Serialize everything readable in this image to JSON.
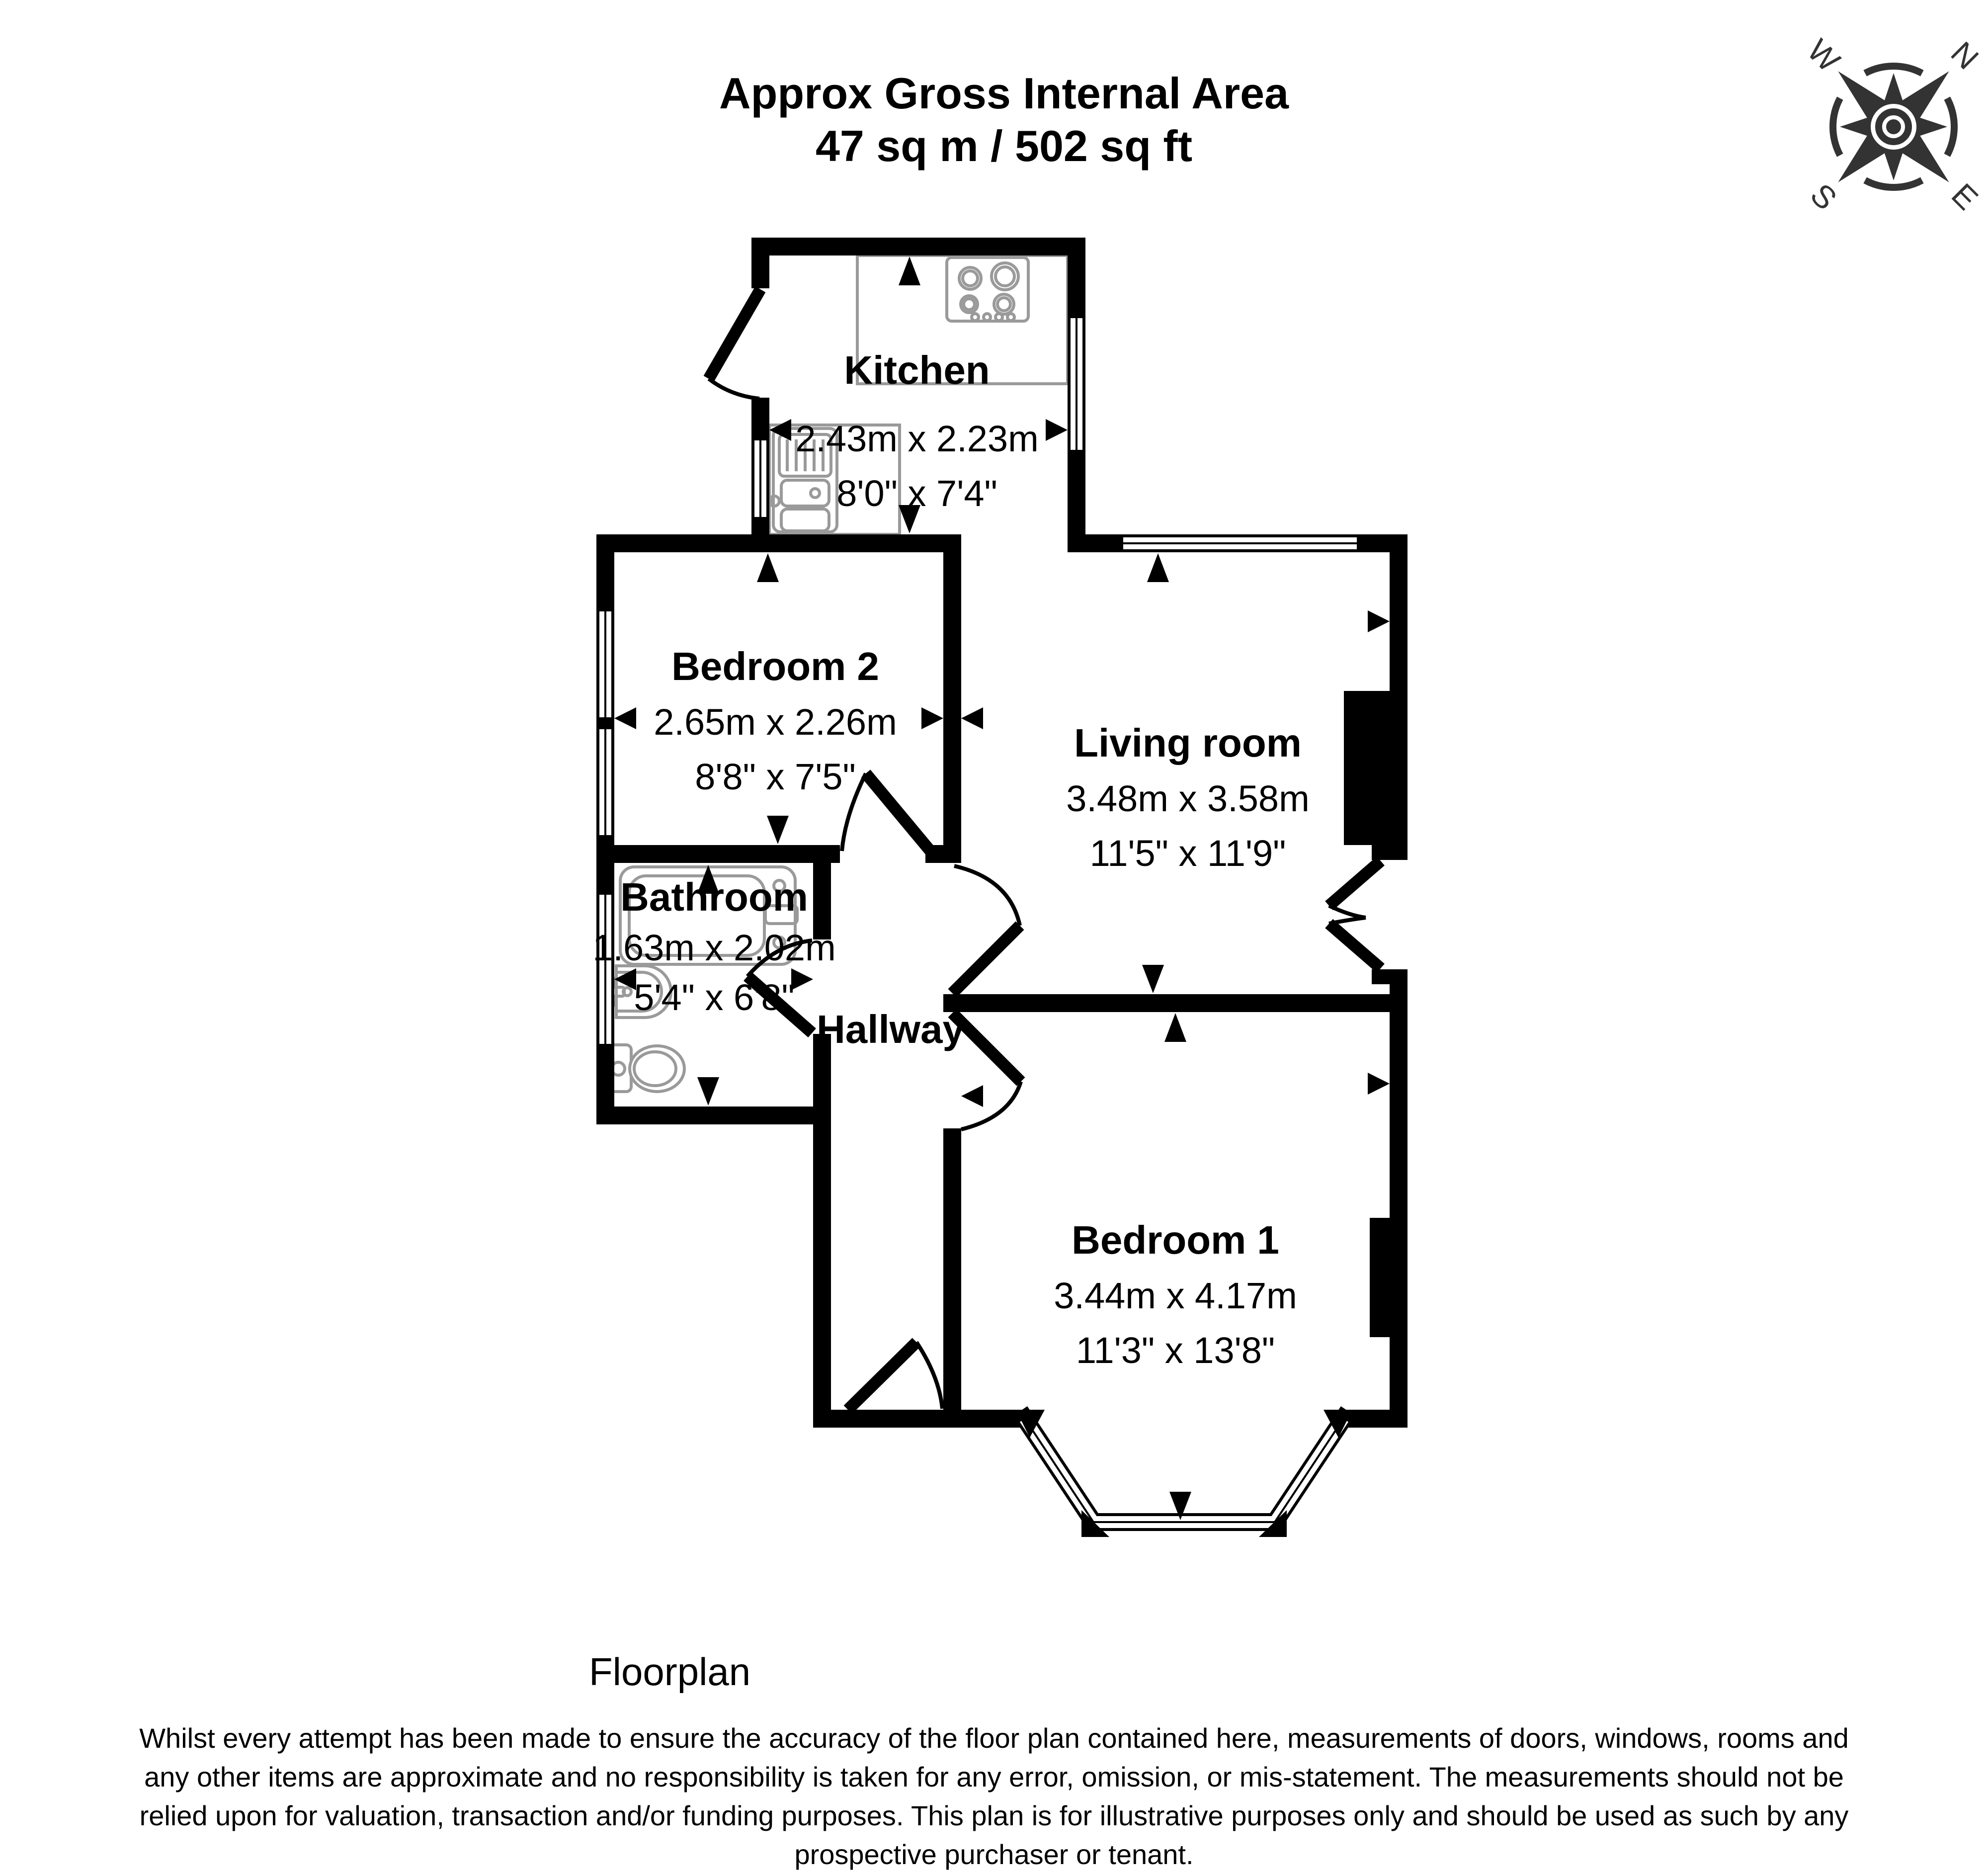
{
  "title": {
    "line1": "Approx Gross Internal Area",
    "line2": "47 sq m / 502 sq ft"
  },
  "compass": {
    "north": "N",
    "east": "E",
    "south": "S",
    "west": "W"
  },
  "rooms": {
    "kitchen": {
      "name": "Kitchen",
      "dim_metric": "2.43m x 2.23m",
      "dim_imperial": "8'0\" x 7'4\""
    },
    "bedroom2": {
      "name": "Bedroom 2",
      "dim_metric": "2.65m x 2.26m",
      "dim_imperial": "8'8\" x 7'5\""
    },
    "living_room": {
      "name": "Living room",
      "dim_metric": "3.48m x 3.58m",
      "dim_imperial": "11'5\" x 11'9\""
    },
    "bathroom": {
      "name": "Bathroom",
      "dim_metric": "1.63m x 2.02m",
      "dim_imperial": "5'4\" x 6'8\""
    },
    "hallway": {
      "name": "Hallway"
    },
    "bedroom1": {
      "name": "Bedroom 1",
      "dim_metric": "3.44m x 4.17m",
      "dim_imperial": "11'3\" x 13'8\""
    }
  },
  "footer": {
    "plan_label": "Floorplan",
    "disclaimer_lines": [
      "Whilst every attempt has been made to ensure the accuracy of the floor plan contained here, measurements of doors, windows, rooms and",
      "any other items are approximate and no responsibility is taken for any error, omission, or mis-statement. The measurements should not be",
      "relied upon for valuation, transaction and/or funding purposes. This plan is for illustrative purposes only and should be used as such by any",
      "prospective purchaser or tenant."
    ]
  },
  "colors": {
    "wall": "#000000",
    "fixture_outline": "#9a9a9a",
    "compass": "#333333"
  }
}
